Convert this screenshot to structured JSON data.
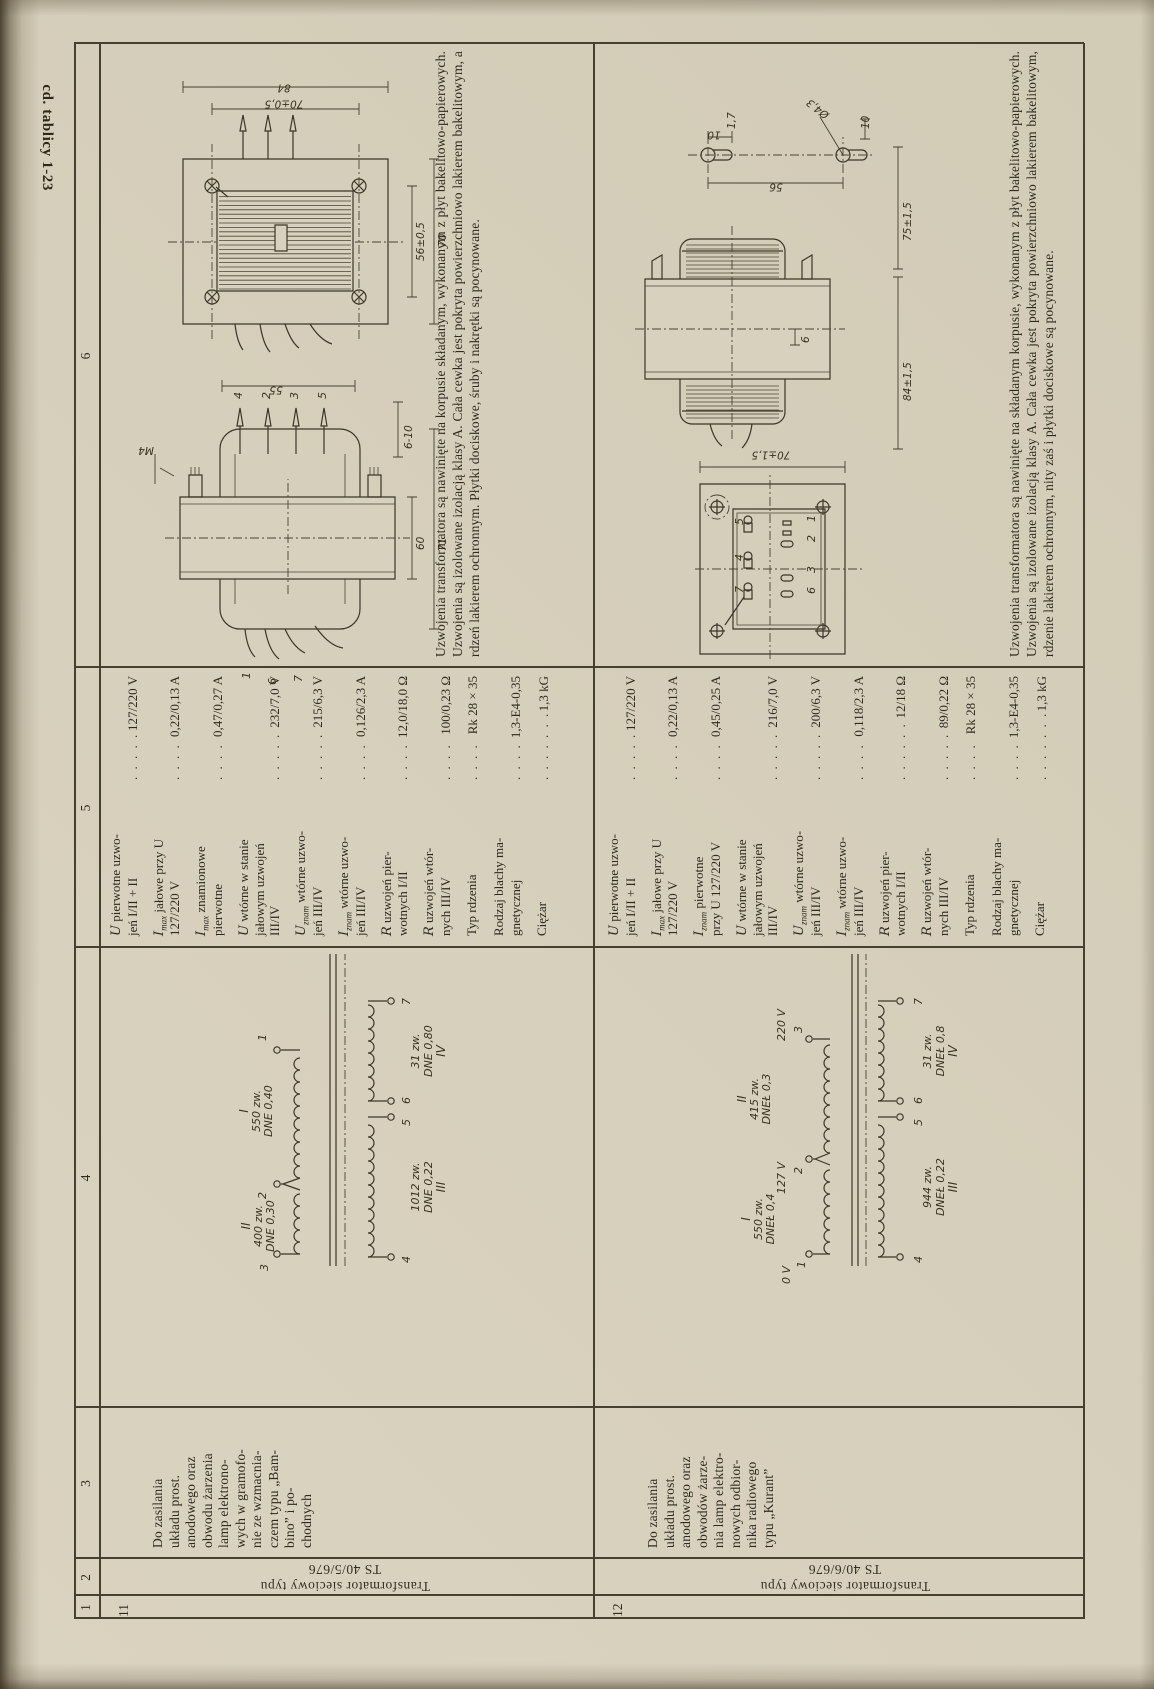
{
  "caption": "cd. tablicy 1-23",
  "header_columns": [
    "1",
    "2",
    "3",
    "4",
    "5",
    "6"
  ],
  "leader_dots": ". . . . . . . . . . . . . .",
  "rows": [
    {
      "number": "11",
      "type_label": {
        "line1": "Transformator sieciowy typu",
        "line2": "TS 40/5/676"
      },
      "application_lines": [
        "Do  zasilania",
        "układu prost.",
        "anodowego oraz",
        "obwodu żarzenia",
        "lamp elektrono-",
        "wych w gramofo-",
        "nie ze wzmacnia-",
        "czem typu „Bam-",
        "bino” i po-",
        "chodnych"
      ],
      "schematic": {
        "primary_terminals": [
          {
            "number": "3",
            "voltage": ""
          },
          {
            "number": "2",
            "voltage": ""
          },
          {
            "number": "1",
            "voltage": ""
          }
        ],
        "primary_windings": [
          {
            "name": "II",
            "turns": "400 zw.",
            "wire": "DNE 0,30"
          },
          {
            "name": "I",
            "turns": "550 zw.",
            "wire": "DNE 0,40"
          }
        ],
        "secondary_windings": [
          {
            "name": "III",
            "turns": "1012 zw.",
            "wire": "DNE 0,22"
          },
          {
            "name": "IV",
            "turns": "31 zw.",
            "wire": "DNE 0,80"
          }
        ],
        "secondary_terminals": [
          "4",
          "5",
          "6",
          "7"
        ]
      },
      "specs": [
        {
          "pre": "U",
          "sub": "",
          "rest": " pierwotne uzwo-\njeń I/II + II",
          "value": "127/220 V"
        },
        {
          "pre": "I",
          "sub": "max",
          "rest": " jałowe przy U\n127/220 V",
          "value": "0,22/0,13 A"
        },
        {
          "pre": "I",
          "sub": "max",
          "rest": " znamionowe\npierwotne",
          "value": "0,47/0,27 A"
        },
        {
          "pre": "U",
          "sub": "",
          "rest": " wtórne w stanie\njałowym  uzwojeń\nIII/IV",
          "value": "232/7,0 V"
        },
        {
          "pre": "U",
          "sub": "znam",
          "rest": " wtórne uzwo-\njeń III/IV",
          "value": "215/6,3 V"
        },
        {
          "pre": "I",
          "sub": "znam",
          "rest": " wtórne uzwo-\njeń III/IV",
          "value": "0,126/2,3 A"
        },
        {
          "pre": "R",
          "sub": "",
          "rest": " uzwojeń  pier-\nwotnych I/II",
          "value": "12,0/18,0 Ω"
        },
        {
          "pre": "R",
          "sub": "",
          "rest": " uzwojeń  wtór-\nnych III/IV",
          "value": "100/0,23 Ω"
        },
        {
          "pre": "",
          "sub": "",
          "rest": "Typ rdzenia",
          "value": "Rk 28 × 35"
        },
        {
          "pre": "",
          "sub": "",
          "rest": "Rodzaj blachy ma-\ngnetycznej",
          "value": "1,3-E4-0,35"
        },
        {
          "pre": "",
          "sub": "",
          "rest": "Ciężar",
          "value": "1,3 kG"
        }
      ],
      "drawings": {
        "front_view": {
          "pin_numbers": [
            "4",
            "2",
            "3",
            "5"
          ],
          "lead_numbers": [
            "1",
            "6",
            "7"
          ],
          "dims": {
            "pin_span": "55",
            "pin_length": "6-10",
            "stud": "M4",
            "core_width": "60",
            "overall_width": "71"
          }
        },
        "side_view": {
          "dims": {
            "height": "84",
            "hole_spacing_v": "70±0,5",
            "hole_spacing_h": "56±0,5",
            "width": "70"
          }
        }
      },
      "note": "Uzwojenia transformatora są nawinięte na korpusie składanym, wykonanym z płyt bakelitowo-papierowych. Uzwojenia są izolowane izolacją klasy A. Cała cewka jest pokryta powierzchniowo lakierem bakelitowym, a rdzeń lakierem ochronnym. Płytki dociskowe, śruby i nakrętki są pocynowane."
    },
    {
      "number": "12",
      "type_label": {
        "line1": "Transformator sieciowy typu",
        "line2": "TS 40/6/676"
      },
      "application_lines": [
        "Do  zasilania",
        "układu prost.",
        "anodowego oraz",
        "obwodów żarze-",
        "nia lamp elektro-",
        "nowych odbior-",
        "nika radiowego",
        "typu „Kurant”"
      ],
      "schematic": {
        "primary_terminals": [
          {
            "number": "1",
            "voltage": "0 V"
          },
          {
            "number": "2",
            "voltage": "127 V"
          },
          {
            "number": "3",
            "voltage": "220 V"
          }
        ],
        "primary_windings": [
          {
            "name": "I",
            "turns": "550 zw.",
            "wire": "DNEŁ 0,4"
          },
          {
            "name": "II",
            "turns": "415 zw.",
            "wire": "DNEŁ 0,3"
          }
        ],
        "secondary_windings": [
          {
            "name": "III",
            "turns": "944 zw.",
            "wire": "DNEŁ 0,22"
          },
          {
            "name": "IV",
            "turns": "31 zw.",
            "wire": "DNEŁ 0,8"
          }
        ],
        "secondary_terminals": [
          "4",
          "5",
          "6",
          "7"
        ]
      },
      "specs": [
        {
          "pre": "U",
          "sub": "",
          "rest": " pierwotne uzwo-\njeń I/II + II",
          "value": "127/220 V"
        },
        {
          "pre": "I",
          "sub": "max",
          "rest": " jałowe przy U\n127/220 V",
          "value": "0,22/0,13 A"
        },
        {
          "pre": "I",
          "sub": "znam",
          "rest": " pierwotne\nprzy U 127/220 V",
          "value": "0,45/0,25 A"
        },
        {
          "pre": "U",
          "sub": "",
          "rest": " wtórne w stanie\njałowym  uzwojeń\nIII/IV",
          "value": "216/7,0 V"
        },
        {
          "pre": "U",
          "sub": "znam",
          "rest": " wtórne uzwo-\njeń III/IV",
          "value": "200/6,3 V"
        },
        {
          "pre": "I",
          "sub": "znam",
          "rest": " wtórne uzwo-\njeń III/IV",
          "value": "0,118/2,3 A"
        },
        {
          "pre": "R",
          "sub": "",
          "rest": " uzwojeń  pier-\nwotnych I/II",
          "value": "12/18 Ω"
        },
        {
          "pre": "R",
          "sub": "",
          "rest": " uzwojeń  wtór-\nnych III/IV",
          "value": "89/0,22 Ω"
        },
        {
          "pre": "",
          "sub": "",
          "rest": "Typ rdzenia",
          "value": "Rk 28 × 35"
        },
        {
          "pre": "",
          "sub": "",
          "rest": "Rodzaj blachy ma-\ngnetycznej",
          "value": "1,3-E4-0,35"
        },
        {
          "pre": "",
          "sub": "",
          "rest": "Ciężar",
          "value": "1,3 kG"
        }
      ],
      "drawings": {
        "side_view": {
          "dims": {
            "width_a": "84±1,5",
            "width_b": "75±1,5",
            "flange": "6"
          }
        },
        "bottom_view": {
          "terminals_top": [
            "7",
            "4",
            "5"
          ],
          "terminals_bottom": [
            "6",
            "3",
            "2",
            "1"
          ],
          "dims": {
            "length": "70±1,5"
          }
        },
        "mounting_detail": {
          "dims": {
            "slot_length": "10",
            "slot_width": "1,7",
            "hole_spacing": "56",
            "hole_dia": "Ø4,3",
            "slot_length2": "10"
          }
        }
      },
      "note": "Uzwojenia transformatora są nawinięte na składanym korpusie, wykonanym z płyt bakelitowo-papierowych. Uzwojenia są izolowane izolacją klasy A. Cała cewka jest pokryta powierzchniowo lakierem bakelitowym, rdzenie lakierem ochronnym, nity zaś i płytki dociskowe są pocynowane."
    }
  ]
}
